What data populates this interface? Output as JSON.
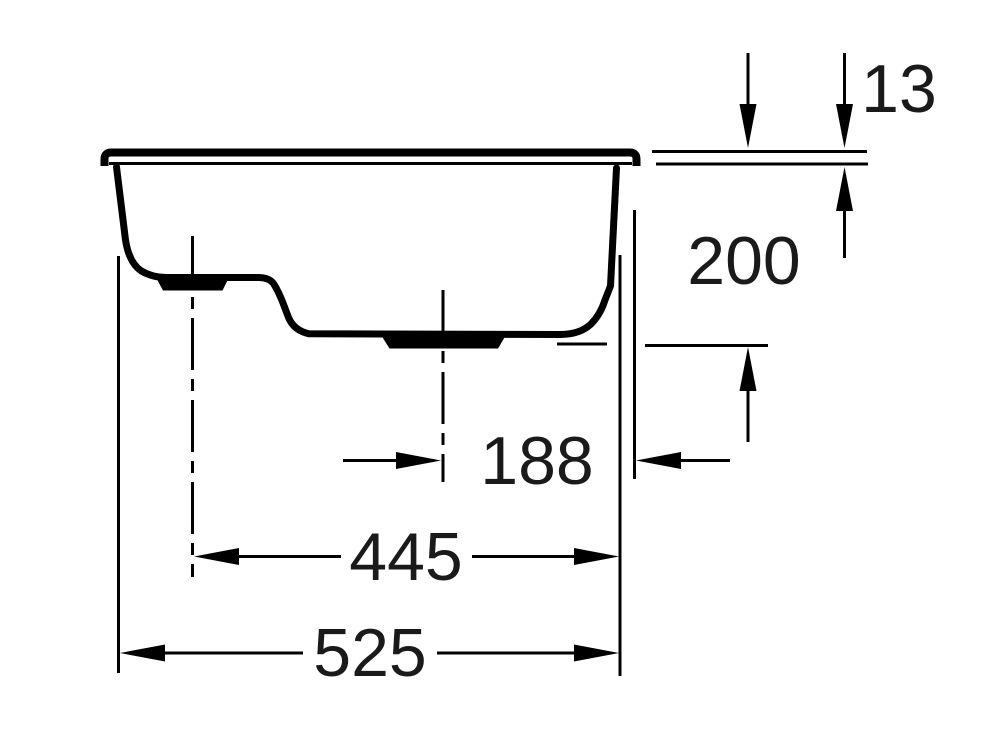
{
  "drawing": {
    "title": "sink side cross-section technical drawing",
    "background_color": "#ffffff",
    "line_color": "#000000",
    "dimensions": [
      {
        "name": "rim-height",
        "label": "13"
      },
      {
        "name": "overall-depth",
        "label": "200"
      },
      {
        "name": "bowl-center-to-right-edge",
        "label": "188"
      },
      {
        "name": "bowl-centers-span",
        "label": "445"
      },
      {
        "name": "overall-width",
        "label": "525"
      }
    ]
  }
}
